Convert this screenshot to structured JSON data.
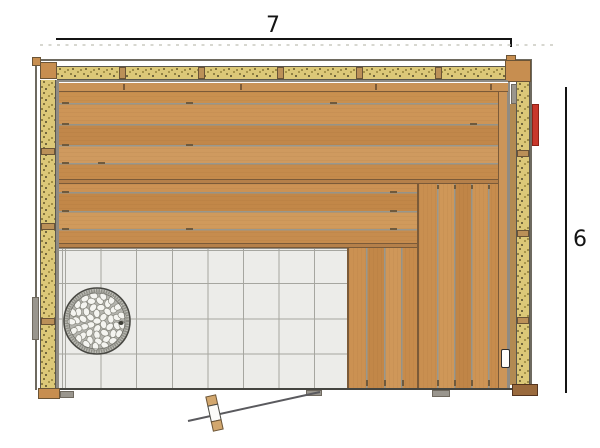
{
  "plan": {
    "width_dimension": "7",
    "height_dimension": "6"
  },
  "colors": {
    "wood": "#c78e50",
    "wood_edge": "#7b5a38",
    "insulation": "#dcc878",
    "tile_floor": "#ecece9",
    "vent_red": "#c8372b",
    "dimension": "#141414",
    "stone": "#f4f4f0"
  }
}
